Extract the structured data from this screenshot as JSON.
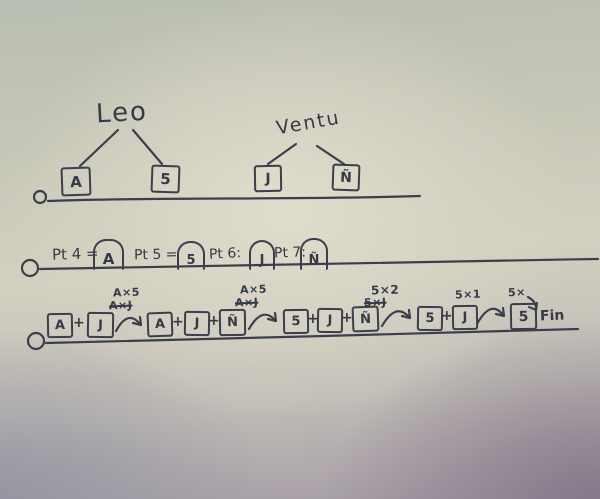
{
  "colors": {
    "ink": "#3a3f4b",
    "paper_center": "#dcd8c9",
    "paper_top": "#b8beb1",
    "paper_bottom_left": "#9a9aa2",
    "paper_bottom_right": "#8d8494"
  },
  "plus": "+",
  "trees": [
    {
      "name": "Leo",
      "children": [
        "A",
        "5"
      ]
    },
    {
      "name": "Ventu",
      "children": [
        "J",
        "Ñ"
      ]
    }
  ],
  "assignments": [
    {
      "prefix": "Pt 4 =",
      "value": "A"
    },
    {
      "prefix": "Pt 5 =",
      "value": "5"
    },
    {
      "prefix": "Pt 6:",
      "value": "J"
    },
    {
      "prefix": "Pt 7:",
      "value": "Ñ"
    }
  ],
  "sequence": {
    "groups": [
      {
        "terms": [
          "A",
          "J"
        ],
        "note": "A×5",
        "note_struck": "A×J"
      },
      {
        "terms": [
          "A",
          "J",
          "Ñ"
        ],
        "note": "A×5",
        "note_struck": "A×J"
      },
      {
        "terms": [
          "5",
          "J",
          "Ñ"
        ],
        "note": "5×2",
        "note_struck": "5×J"
      },
      {
        "terms": [
          "5",
          "J"
        ],
        "note": "5×1",
        "note_struck": ""
      },
      {
        "terms": [
          "5"
        ],
        "note": "5×",
        "note_struck": ""
      }
    ],
    "end_label": "Fin"
  }
}
